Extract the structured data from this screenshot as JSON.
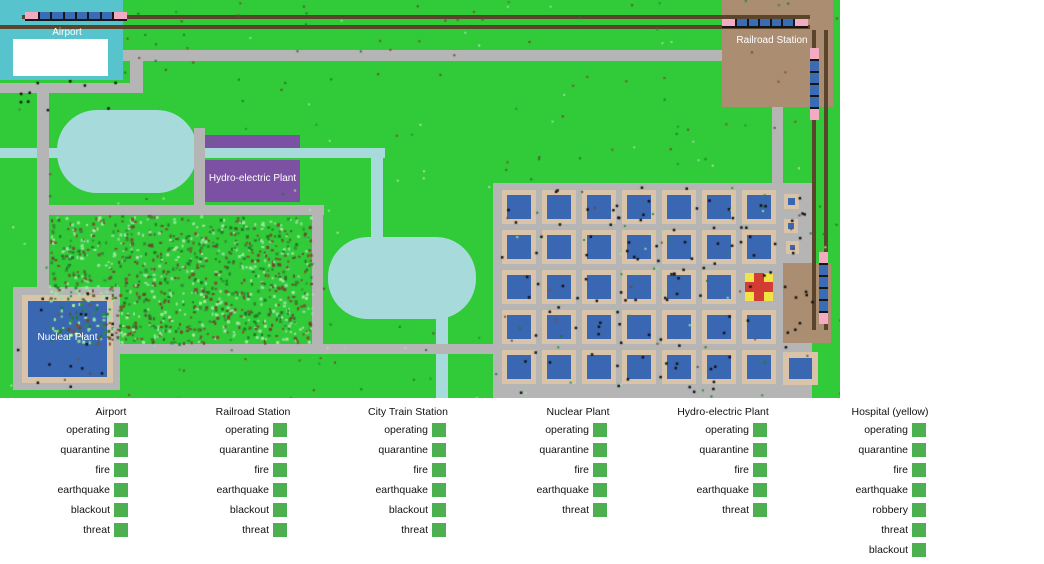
{
  "colors": {
    "grass": "#31ca39",
    "water": "#a7dbdb",
    "road": "#b5b5b5",
    "teal": "#57c3cd",
    "station_brown": "#ab8d71",
    "rail": "#5a452c",
    "purple": "#7c50a3",
    "pink": "#f2abc0",
    "trainblue": "#3a6cb5",
    "tan": "#dac4a9",
    "bluebldg": "#3a67b2",
    "hospital_yellow": "#f0e342",
    "hospital_red": "#d23c32",
    "indicator": "#4caf50"
  },
  "map": {
    "airport": {
      "label": "Airport"
    },
    "railroad_station": {
      "label": "Railroad Station"
    },
    "city_train_station": {
      "lines": [
        "City",
        "Train",
        "Station"
      ]
    },
    "hydro_plant": {
      "label": "Hydro-electric Plant"
    },
    "nuclear_plant": {
      "label": "Nuclear Plant"
    },
    "city": {
      "rows": 5,
      "cols": 7,
      "hospital_cell": {
        "row": 3,
        "col": 7
      },
      "small_buildings": 3,
      "extra_building": 1
    },
    "trains": {
      "horizontal": 2,
      "vertical": 2
    }
  },
  "panel": {
    "columns": [
      {
        "title": "Airport",
        "title_cx": 111,
        "sq_x": 114,
        "items": [
          "operating",
          "quarantine",
          "fire",
          "earthquake",
          "blackout",
          "threat"
        ]
      },
      {
        "title": "Railroad Station",
        "title_cx": 253,
        "sq_x": 273,
        "items": [
          "operating",
          "quarantine",
          "fire",
          "earthquake",
          "blackout",
          "threat"
        ]
      },
      {
        "title": "City Train Station",
        "title_cx": 408,
        "sq_x": 432,
        "items": [
          "operating",
          "quarantine",
          "fire",
          "earthquake",
          "blackout",
          "threat"
        ]
      },
      {
        "title": "Nuclear Plant",
        "title_cx": 578,
        "sq_x": 593,
        "items": [
          "operating",
          "quarantine",
          "fire",
          "earthquake",
          "threat"
        ]
      },
      {
        "title": "Hydro-electric Plant",
        "title_cx": 723,
        "sq_x": 753,
        "items": [
          "operating",
          "quarantine",
          "fire",
          "earthquake",
          "threat"
        ]
      },
      {
        "title": "Hospital (yellow)",
        "title_cx": 890,
        "sq_x": 912,
        "items": [
          "operating",
          "quarantine",
          "fire",
          "earthquake",
          "robbery",
          "threat",
          "blackout"
        ]
      }
    ],
    "all_status": "on"
  }
}
